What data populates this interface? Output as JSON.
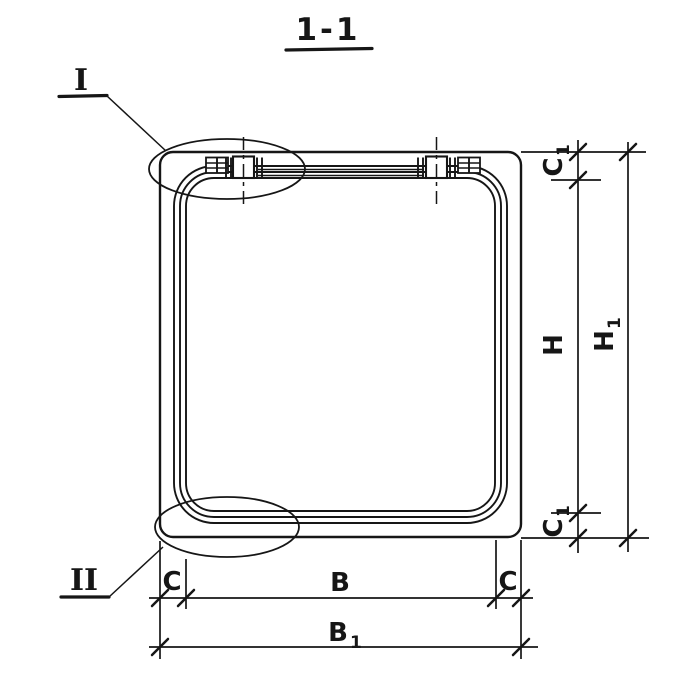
{
  "colors": {
    "ink": "#161616",
    "background": "#ffffff"
  },
  "title": {
    "label": "1-1"
  },
  "callouts": {
    "detail_top": "I",
    "detail_bottom": "II"
  },
  "dimensions": {
    "c1_top": {
      "main": "C",
      "sub": "1"
    },
    "h": {
      "main": "H"
    },
    "c1_bottom": {
      "main": "C",
      "sub": "1"
    },
    "h1": {
      "main": "H",
      "sub": "1"
    },
    "c_left": {
      "main": "C"
    },
    "b": {
      "main": "B"
    },
    "c_right": {
      "main": "C"
    },
    "b1": {
      "main": "B",
      "sub": "1"
    }
  }
}
